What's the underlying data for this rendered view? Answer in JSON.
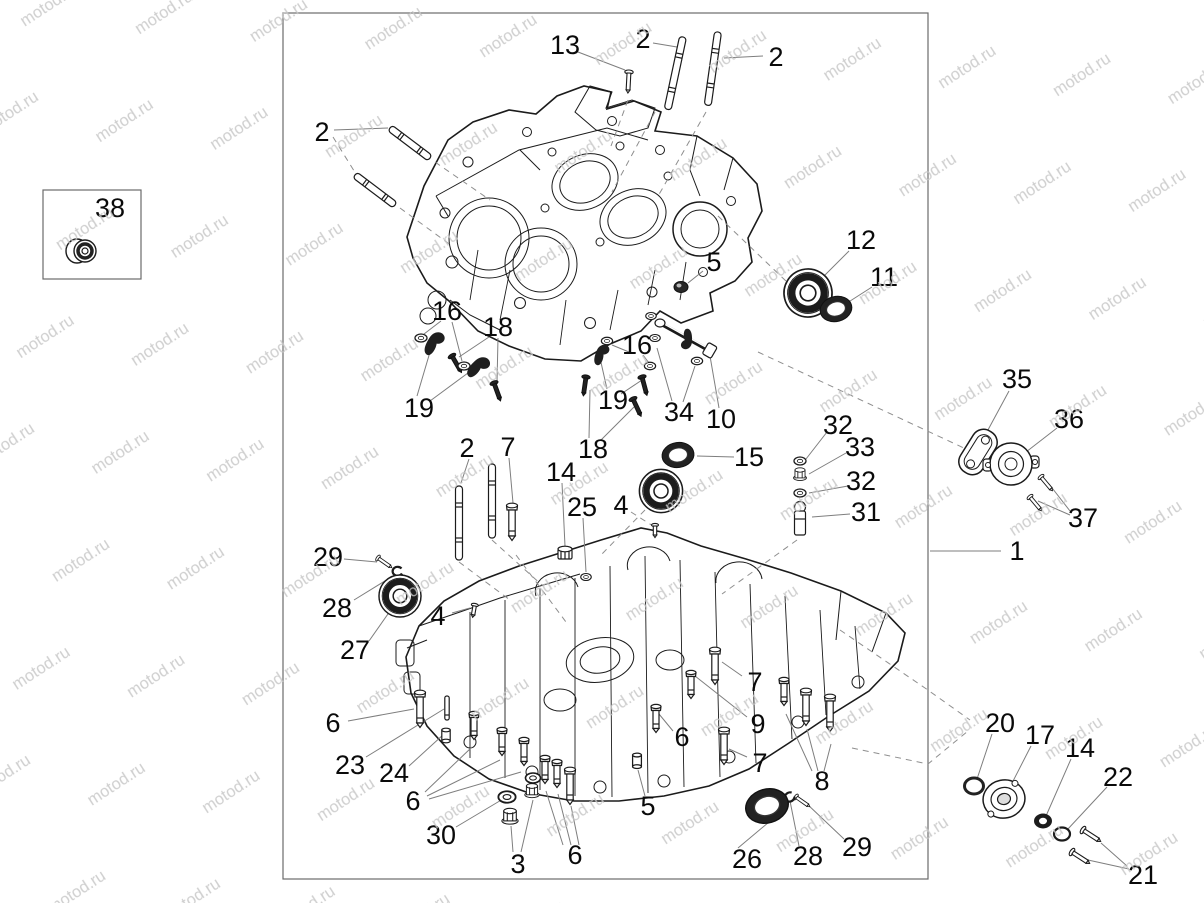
{
  "watermark": {
    "text": "motod.ru",
    "color": "#c6c6c6"
  },
  "colors": {
    "line": "#1b1b1b",
    "leader": "#7e7e7e",
    "border": "#6b6b6b",
    "background": "#ffffff"
  },
  "inset_box": {
    "label": "38"
  },
  "callouts": [
    {
      "name": "callout-13",
      "label": "13"
    },
    {
      "name": "callout-2-top-a",
      "label": "2"
    },
    {
      "name": "callout-2-top-b",
      "label": "2"
    },
    {
      "name": "callout-2-upper-left",
      "label": "2"
    },
    {
      "name": "callout-38",
      "label": "38"
    },
    {
      "name": "callout-12",
      "label": "12"
    },
    {
      "name": "callout-11",
      "label": "11"
    },
    {
      "name": "callout-5-upper",
      "label": "5"
    },
    {
      "name": "callout-16-left",
      "label": "16"
    },
    {
      "name": "callout-18-left",
      "label": "18"
    },
    {
      "name": "callout-19-left",
      "label": "19"
    },
    {
      "name": "callout-16-right",
      "label": "16"
    },
    {
      "name": "callout-19-right",
      "label": "19"
    },
    {
      "name": "callout-34",
      "label": "34"
    },
    {
      "name": "callout-10",
      "label": "10"
    },
    {
      "name": "callout-18-right",
      "label": "18"
    },
    {
      "name": "callout-2-mid",
      "label": "2"
    },
    {
      "name": "callout-7-mid",
      "label": "7"
    },
    {
      "name": "callout-14-mid",
      "label": "14"
    },
    {
      "name": "callout-25",
      "label": "25"
    },
    {
      "name": "callout-15",
      "label": "15"
    },
    {
      "name": "callout-32-a",
      "label": "32"
    },
    {
      "name": "callout-33",
      "label": "33"
    },
    {
      "name": "callout-32-b",
      "label": "32"
    },
    {
      "name": "callout-31",
      "label": "31"
    },
    {
      "name": "callout-35",
      "label": "35"
    },
    {
      "name": "callout-36",
      "label": "36"
    },
    {
      "name": "callout-37",
      "label": "37"
    },
    {
      "name": "callout-1",
      "label": "1"
    },
    {
      "name": "callout-29-left",
      "label": "29"
    },
    {
      "name": "callout-28-left",
      "label": "28"
    },
    {
      "name": "callout-27",
      "label": "27"
    },
    {
      "name": "callout-4-left",
      "label": "4"
    },
    {
      "name": "callout-4-right",
      "label": "4"
    },
    {
      "name": "callout-6-a",
      "label": "6"
    },
    {
      "name": "callout-23",
      "label": "23"
    },
    {
      "name": "callout-24",
      "label": "24"
    },
    {
      "name": "callout-6-b",
      "label": "6"
    },
    {
      "name": "callout-30",
      "label": "30"
    },
    {
      "name": "callout-3",
      "label": "3"
    },
    {
      "name": "callout-6-c",
      "label": "6"
    },
    {
      "name": "callout-5-lower",
      "label": "5"
    },
    {
      "name": "callout-6-d",
      "label": "6"
    },
    {
      "name": "callout-9",
      "label": "9"
    },
    {
      "name": "callout-7-top",
      "label": "7"
    },
    {
      "name": "callout-7-bottom",
      "label": "7"
    },
    {
      "name": "callout-8",
      "label": "8"
    },
    {
      "name": "callout-26",
      "label": "26"
    },
    {
      "name": "callout-28-lower",
      "label": "28"
    },
    {
      "name": "callout-29-lower",
      "label": "29"
    },
    {
      "name": "callout-20",
      "label": "20"
    },
    {
      "name": "callout-17",
      "label": "17"
    },
    {
      "name": "callout-14-lower",
      "label": "14"
    },
    {
      "name": "callout-22",
      "label": "22"
    },
    {
      "name": "callout-21",
      "label": "21"
    }
  ]
}
